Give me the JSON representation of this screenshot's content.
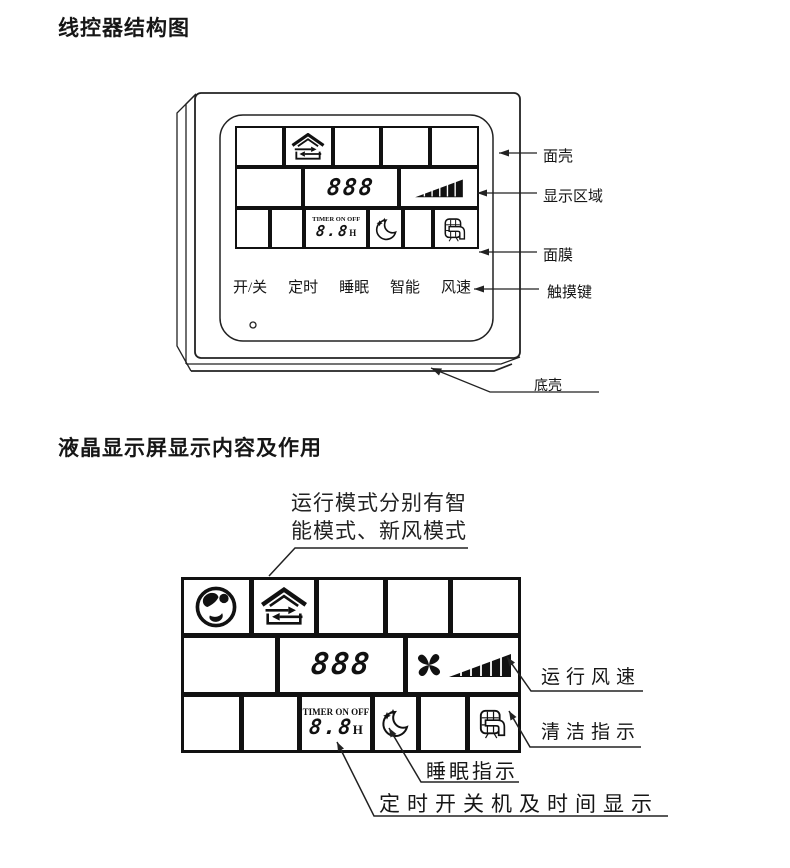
{
  "titles": {
    "structure": "线控器结构图",
    "lcd": "液晶显示屏显示内容及作用"
  },
  "controller": {
    "display": {
      "mode_digits": "888",
      "timer_label": "TIMER ON OFF",
      "timer_digits": "8.8",
      "timer_unit": "H"
    },
    "buttons": [
      {
        "label": "开/关"
      },
      {
        "label": "定时"
      },
      {
        "label": "睡眠"
      },
      {
        "label": "智能"
      },
      {
        "label": "风速"
      }
    ],
    "callouts": {
      "front_shell": "面壳",
      "display_area": "显示区域",
      "membrane": "面膜",
      "touch_keys": "触摸键",
      "bottom_shell": "底壳"
    }
  },
  "lcd_screen": {
    "annotation": {
      "line1": "运行模式分别有智",
      "line2": "能模式、新风模式"
    },
    "display": {
      "mode_digits": "888",
      "timer_label": "TIMER ON OFF",
      "timer_digits": "8.8",
      "timer_unit": "H"
    },
    "callouts": {
      "fan_speed": "运行风速",
      "clean": "清洁指示",
      "sleep": "睡眠指示",
      "timer": "定时开关机及时间显示"
    }
  },
  "icons": {
    "globe": "globe-earth-icon",
    "fresh_air": "fresh-air-house-icon",
    "fan": "fan-blades-icon",
    "speed_ramp": "fan-speed-ramp-icon",
    "sleep_moon": "sleep-moon-icon",
    "clean_filter": "clean-filter-icon"
  },
  "colors": {
    "line": "#222222",
    "ink": "#161616"
  }
}
